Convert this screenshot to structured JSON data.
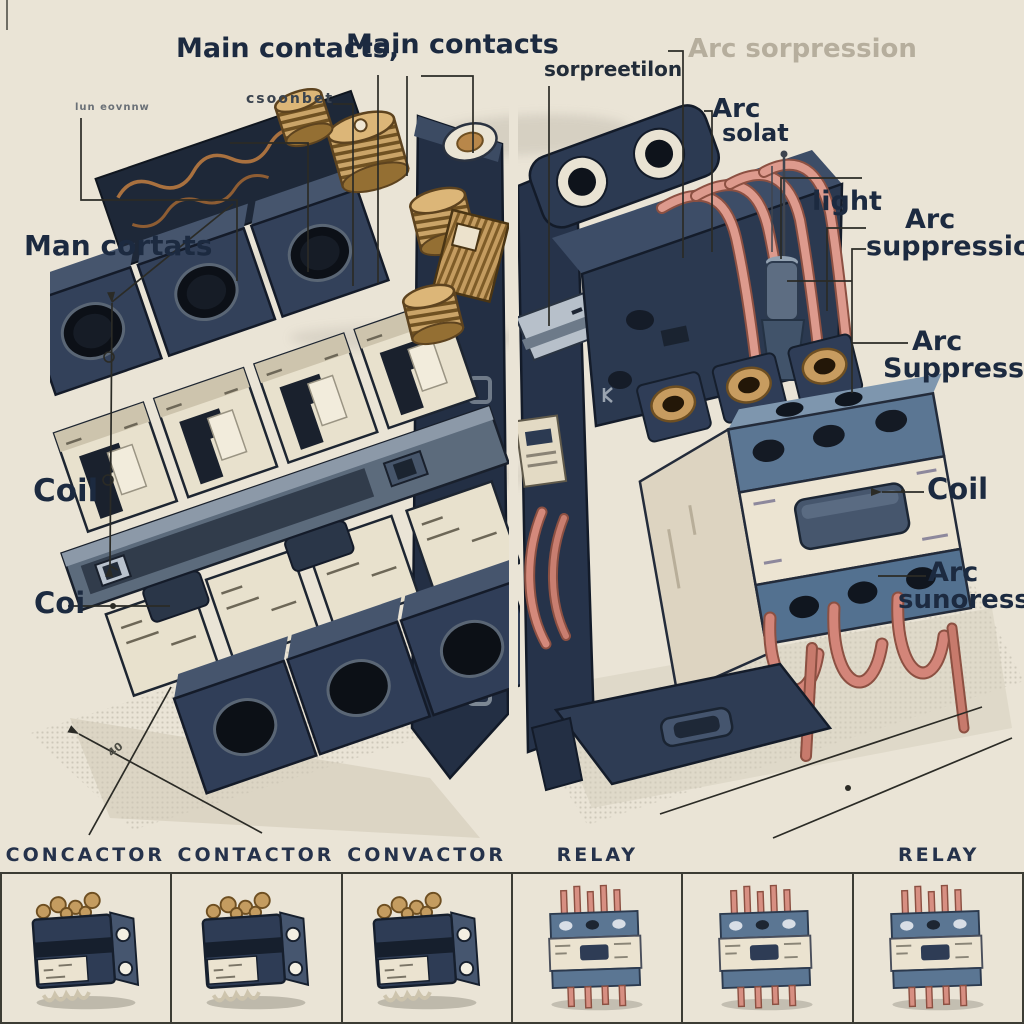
{
  "palette": {
    "paper": "#eae4d6",
    "ink": "#1c2a40",
    "line": "#2b2b26",
    "ghost": "#b6ae9d",
    "navy": "#2e3c55",
    "navy_dark": "#161f2d",
    "navy_light": "#46566f",
    "steel": "#5b7693",
    "steel_light": "#7e96ae",
    "cream": "#ebe3d0",
    "cream_dark": "#cdc4ad",
    "copper": "#d78f82",
    "copper_dark": "#8c5042",
    "brass": "#c49c60",
    "brass_dark": "#6e4f22",
    "hole": "#0e1218"
  },
  "annotations": [
    {
      "name": "label-main-contacts-left",
      "text": "Main contacts,",
      "x": 176,
      "y": 35,
      "size": 27,
      "weight": 600
    },
    {
      "name": "label-main-contacts-right",
      "text": "Main contacts",
      "x": 346,
      "y": 31,
      "size": 27,
      "weight": 600
    },
    {
      "name": "label-garbled-top-left",
      "text": "lun eovnnw",
      "x": 75,
      "y": 103,
      "size": 10,
      "weight": 600,
      "color": "#6a7077",
      "ls": 1
    },
    {
      "name": "label-garbled-csoonbet",
      "text": "csoonbet",
      "x": 246,
      "y": 92,
      "size": 14,
      "weight": 700,
      "color": "#3a434f",
      "ls": 2
    },
    {
      "name": "label-man-cortats",
      "text": "Man cortats",
      "x": 24,
      "y": 231,
      "size": 28,
      "weight": 600
    },
    {
      "name": "label-coil-left",
      "text": "Coil",
      "x": 33,
      "y": 475,
      "size": 31,
      "weight": 600
    },
    {
      "name": "label-coi",
      "text": "Coi",
      "x": 34,
      "y": 588,
      "size": 29,
      "weight": 600
    },
    {
      "name": "label-sorpreetilon",
      "text": "sorpreetilon",
      "x": 544,
      "y": 59,
      "size": 20,
      "weight": 700,
      "color": "#222c39"
    },
    {
      "name": "label-arc-sorpression-ghost",
      "text": "Arc sorpression",
      "x": 688,
      "y": 36,
      "size": 26,
      "weight": 600,
      "color": "#b6ae9d"
    },
    {
      "name": "label-arc-small",
      "text": "Arc",
      "x": 712,
      "y": 96,
      "size": 26,
      "weight": 600
    },
    {
      "name": "label-solat",
      "text": "solat",
      "x": 722,
      "y": 121,
      "size": 24,
      "weight": 600
    },
    {
      "name": "label-light",
      "text": "light",
      "x": 812,
      "y": 188,
      "size": 27,
      "weight": 600
    },
    {
      "name": "label-arc-suppression-1a",
      "text": "Arc",
      "x": 905,
      "y": 206,
      "size": 27,
      "weight": 600
    },
    {
      "name": "label-arc-suppression-1b",
      "text": "suppression",
      "x": 866,
      "y": 233,
      "size": 27,
      "weight": 600
    },
    {
      "name": "label-arc-suppression-2a",
      "text": "Arc",
      "x": 912,
      "y": 328,
      "size": 27,
      "weight": 600
    },
    {
      "name": "label-arc-suppression-2b",
      "text": "Suppression",
      "x": 883,
      "y": 355,
      "size": 27,
      "weight": 600
    },
    {
      "name": "label-coil-right",
      "text": "Coil",
      "x": 927,
      "y": 474,
      "size": 29,
      "weight": 600
    },
    {
      "name": "label-arc-sunoression-a",
      "text": "Arc",
      "x": 928,
      "y": 559,
      "size": 27,
      "weight": 600
    },
    {
      "name": "label-arc-sunoression-b",
      "text": "sunoression",
      "x": 898,
      "y": 587,
      "size": 26,
      "weight": 600
    },
    {
      "name": "label-ground-40",
      "text": "40",
      "x": 106,
      "y": 750,
      "size": 11,
      "weight": 600,
      "rotate": -38,
      "color": "#4c4c44"
    }
  ],
  "leader_lines": [
    {
      "name": "leader-main-contacts-1",
      "points": [
        [
          378,
          75
        ],
        [
          378,
          283
        ]
      ]
    },
    {
      "name": "leader-main-contacts-2a",
      "points": [
        [
          407,
          76
        ],
        [
          407,
          176
        ]
      ]
    },
    {
      "name": "leader-main-contacts-2b",
      "points": [
        [
          421,
          76
        ],
        [
          473,
          76
        ],
        [
          473,
          153
        ]
      ]
    },
    {
      "name": "leader-csoonbet",
      "points": [
        [
          333,
          104
        ],
        [
          353,
          104
        ],
        [
          353,
          286
        ]
      ]
    },
    {
      "name": "leader-left-step",
      "points": [
        [
          230,
          143
        ],
        [
          308,
          143
        ],
        [
          308,
          272
        ]
      ]
    },
    {
      "name": "leader-tiny-left",
      "points": [
        [
          81,
          118
        ],
        [
          81,
          200
        ],
        [
          237,
          200
        ],
        [
          237,
          281
        ]
      ]
    },
    {
      "name": "dimension-diagonal",
      "points": [
        [
          112,
          302
        ],
        [
          233,
          204
        ]
      ]
    },
    {
      "name": "dimension-vertical",
      "points": [
        [
          112,
          303
        ],
        [
          110,
          566
        ],
        [
          118,
          570
        ]
      ]
    },
    {
      "name": "leader-coi",
      "points": [
        [
          68,
          606
        ],
        [
          170,
          606
        ]
      ]
    },
    {
      "name": "ground-line-left-1",
      "points": [
        [
          79,
          734
        ],
        [
          262,
          833
        ]
      ]
    },
    {
      "name": "ground-line-left-2",
      "points": [
        [
          171,
          687
        ],
        [
          89,
          835
        ]
      ]
    },
    {
      "name": "leader-ghost-corner",
      "points": [
        [
          668,
          51
        ],
        [
          683,
          51
        ],
        [
          683,
          258
        ]
      ]
    },
    {
      "name": "leader-sorpreetilon",
      "points": [
        [
          549,
          86
        ],
        [
          549,
          326
        ]
      ]
    },
    {
      "name": "leader-arc-solat",
      "points": [
        [
          704,
          111
        ],
        [
          712,
          111
        ],
        [
          712,
          252
        ]
      ]
    },
    {
      "name": "leader-light",
      "points": [
        [
          862,
          178
        ],
        [
          781,
          178
        ],
        [
          781,
          259
        ]
      ]
    },
    {
      "name": "leader-arc-suppression-1",
      "points": [
        [
          866,
          228
        ],
        [
          827,
          228
        ],
        [
          827,
          311
        ]
      ]
    },
    {
      "name": "leader-suppression-bracket",
      "points": [
        [
          866,
          249
        ],
        [
          852,
          249
        ],
        [
          852,
          393
        ]
      ]
    },
    {
      "name": "leader-suppression-branch",
      "points": [
        [
          852,
          281
        ],
        [
          787,
          281
        ]
      ]
    },
    {
      "name": "leader-to-arc-2",
      "points": [
        [
          852,
          343
        ],
        [
          908,
          343
        ]
      ]
    },
    {
      "name": "leader-coil-right",
      "points": [
        [
          882,
          492
        ],
        [
          924,
          492
        ]
      ]
    },
    {
      "name": "leader-arc-sunoression",
      "points": [
        [
          878,
          576
        ],
        [
          926,
          576
        ]
      ]
    },
    {
      "name": "ground-line-right-1",
      "points": [
        [
          660,
          814
        ],
        [
          982,
          707
        ]
      ]
    },
    {
      "name": "ground-line-right-2",
      "points": [
        [
          773,
          838
        ],
        [
          1012,
          738
        ]
      ]
    }
  ],
  "markers": {
    "dots": [
      {
        "name": "dot-coi-line",
        "x": 113,
        "y": 606,
        "r": 3
      },
      {
        "name": "dot-ground-right",
        "x": 848,
        "y": 788,
        "r": 3
      },
      {
        "name": "dot-coil-right-line",
        "x": 903,
        "y": 491,
        "r": 2
      }
    ],
    "circles": [
      {
        "name": "dimension-circle-upper",
        "x": 109,
        "y": 357,
        "r": 5
      },
      {
        "name": "dimension-circle-lower",
        "x": 108,
        "y": 480,
        "r": 5
      }
    ],
    "arrows": [
      {
        "name": "arrow-ground-left",
        "x": 79,
        "y": 734,
        "angle": 208
      },
      {
        "name": "arrow-coil-right",
        "x": 882,
        "y": 492,
        "angle": 180
      },
      {
        "name": "arrow-dimension-bottom",
        "x": 110,
        "y": 566,
        "angle": 95
      },
      {
        "name": "arrow-dimension-top",
        "x": 112,
        "y": 303,
        "angle": 265
      }
    ]
  },
  "bottom_strip": {
    "cells": [
      {
        "caption": "CONCACTOR",
        "kind": "contactor"
      },
      {
        "caption": "CONTACTOR",
        "kind": "contactor"
      },
      {
        "caption": "CONVACTOR",
        "kind": "contactor"
      },
      {
        "caption": "RELAY",
        "kind": "relay"
      },
      {
        "caption": "",
        "kind": "relay"
      },
      {
        "caption": "RELAY",
        "kind": "relay"
      }
    ]
  }
}
